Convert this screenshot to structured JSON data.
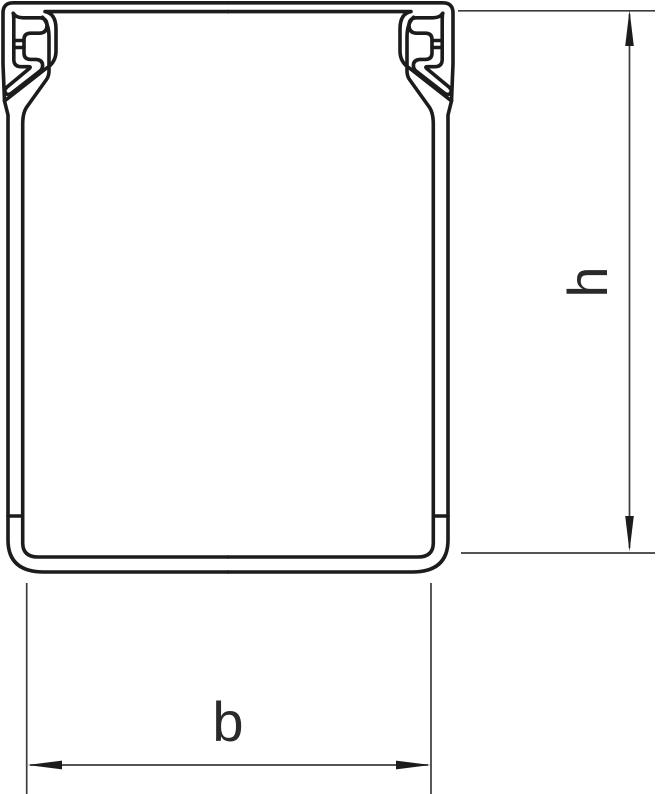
{
  "diagram": {
    "dimensions": {
      "height_label": "h",
      "width_label": "b"
    },
    "colors": {
      "outline": "#1c1c1c",
      "dimension_line": "#3c3c3c",
      "label_text": "#2a2a2a",
      "background": "#ffffff"
    }
  }
}
